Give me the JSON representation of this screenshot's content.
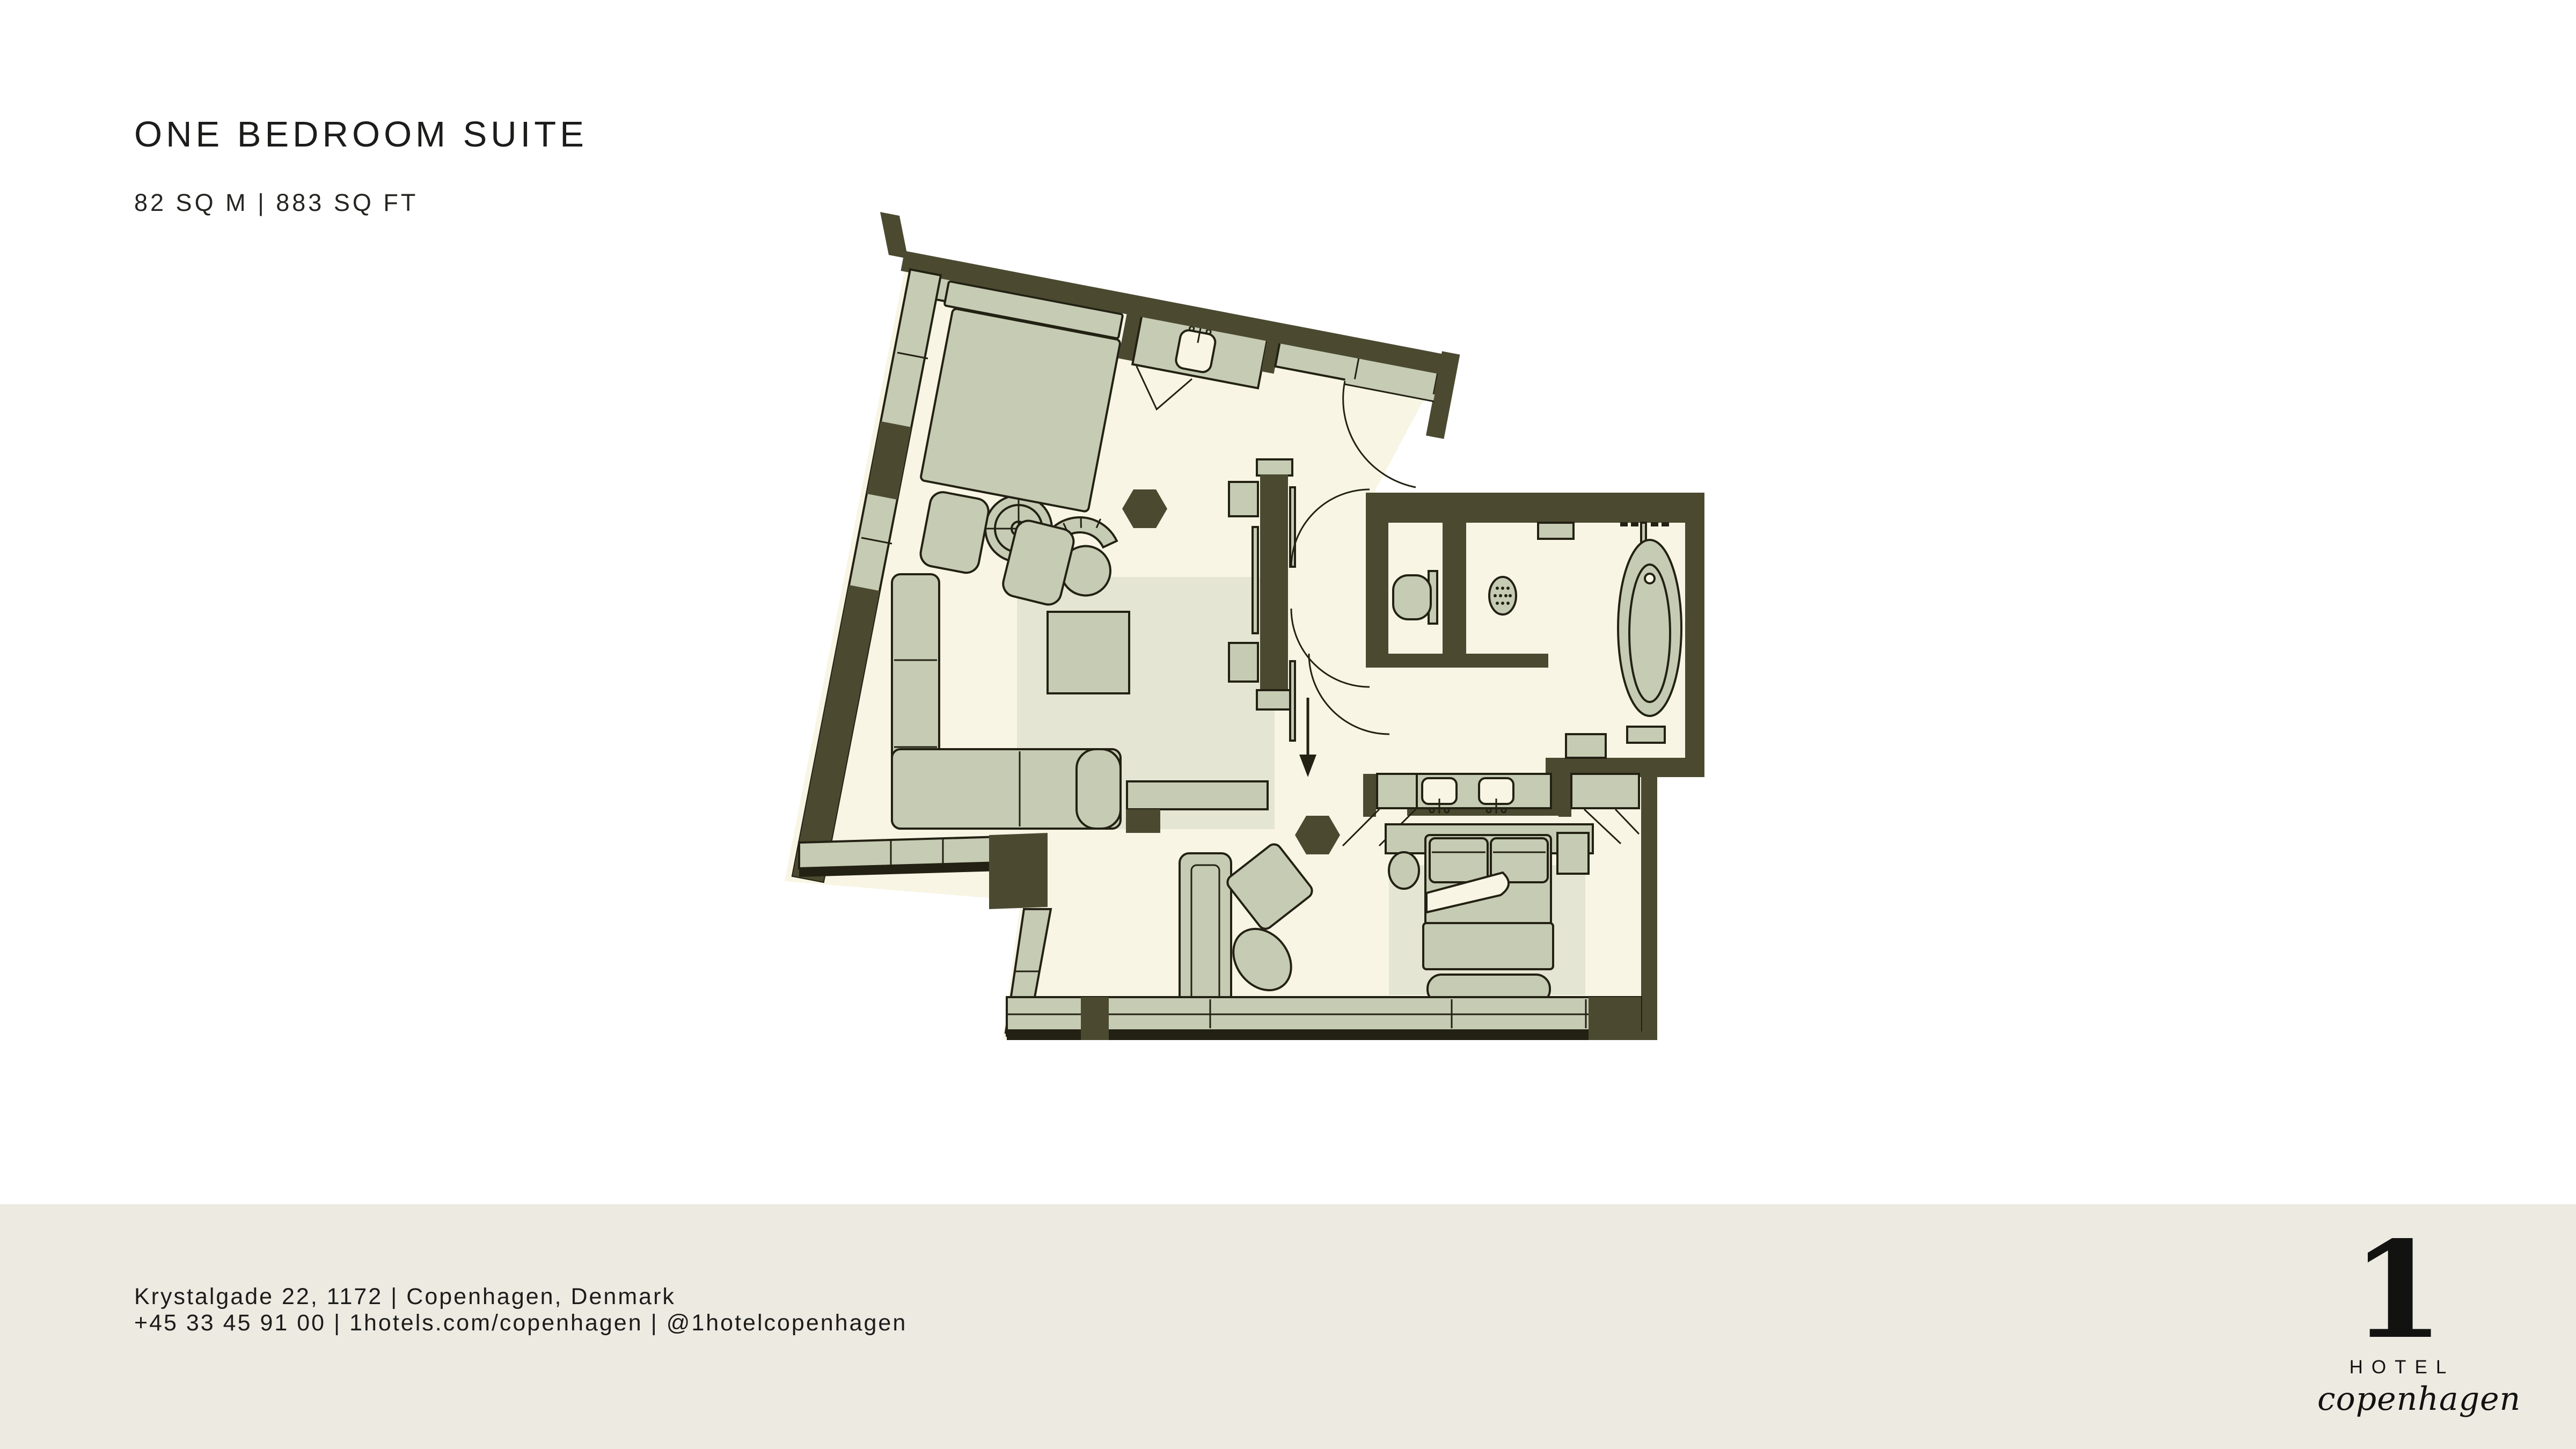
{
  "page": {
    "title": "ONE BEDROOM SUITE",
    "subtitle": "82 SQ M | 883 SQ FT"
  },
  "footer": {
    "address": "Krystalgade 22, 1172 | Copenhagen, Denmark",
    "contact": "+45 33 45 91 00 | 1hotels.com/copenhagen | @1hotelcopenhagen"
  },
  "logo": {
    "numeral": "1",
    "hotel": "HOTEL",
    "city": "copenhagen"
  },
  "colors": {
    "background": "#ffffff",
    "footer_band": "#eceae1",
    "wall": "#4b4a31",
    "floor": "#f8f5e4",
    "furniture": "#c6cbb3",
    "rug": "#e4e5d2",
    "outline": "#222113",
    "text": "#1c1c1b"
  }
}
